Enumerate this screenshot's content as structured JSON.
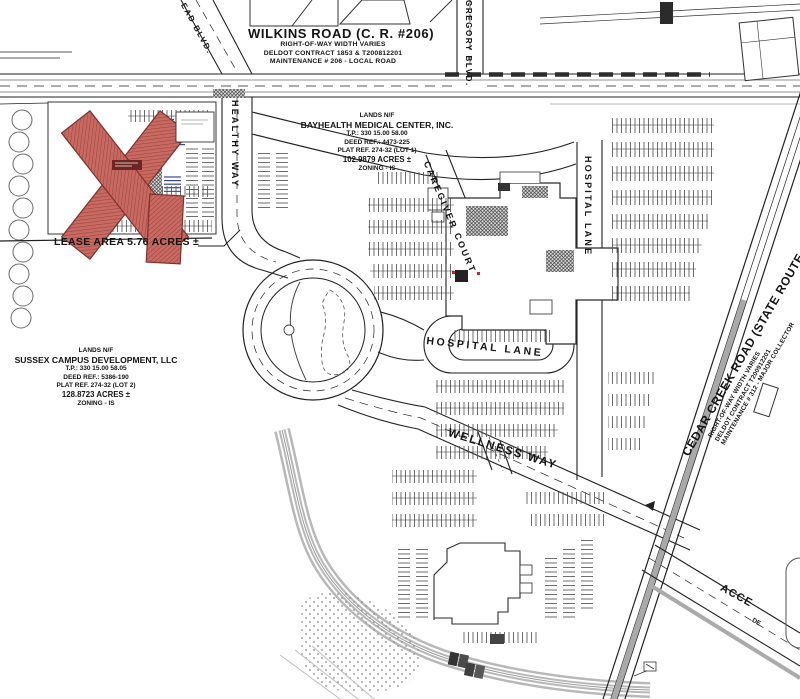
{
  "drawing": {
    "roads": {
      "wilkins": {
        "name": "WILKINS ROAD (C. R. #206)",
        "row": "RIGHT-OF-WAY WIDTH VARIES",
        "contract": "DELDOT CONTRACT 1853 & T200812201",
        "maintenance": "MAINTENANCE # 206 - LOCAL ROAD"
      },
      "ead_blvd": {
        "name": "EAD BLVD."
      },
      "gregory_blvd": {
        "name": "GREGORY BLVD."
      },
      "healthy_way": {
        "name": "HEALTHY WAY"
      },
      "caregiver_court": {
        "name": "CAREGIVER COURT"
      },
      "hospital_lane_upper": {
        "name": "HOSPITAL LANE"
      },
      "hospital_lane_lower": {
        "name": "HOSPITAL LANE"
      },
      "wellness_way": {
        "name": "WELLNESS WAY"
      },
      "cedar_creek": {
        "name": "CEDAR CREEK ROAD (STATE ROUTE 30)",
        "row": "RIGHT-OF-WAY WIDTH VARIES",
        "contract": "DELDOT CONTRACT T200912201",
        "maintenance": "MAINTENANCE # 312 - MAJOR COLLECTOR"
      },
      "access_road": {
        "name": "ACCE",
        "partial_note": "DE"
      }
    },
    "parcels": {
      "bayhealth": {
        "lands": "LANDS N/F",
        "owner": "BAYHEALTH MEDICAL CENTER, INC.",
        "tax_parcel": "T.P.: 330 15.00 58.00",
        "deed_ref": "DEED REF.: 4473-225",
        "plat_ref": "PLAT REF. 274-32 (LOT 1)",
        "acreage": "102.9879 ACRES ±",
        "zoning": "ZONING - IS"
      },
      "sussex": {
        "lands": "LANDS N/F",
        "owner": "SUSSEX CAMPUS DEVELOPMENT, LLC",
        "tax_parcel": "T.P.: 330 15.00 58.05",
        "deed_ref": "DEED REF.: 5386-190",
        "plat_ref": "PLAT REF. 274-32 (LOT 2)",
        "acreage": "128.8723 ACRES ±",
        "zoning": "ZONING - IS"
      },
      "lease": {
        "callout": "LEASE AREA 5.76 ACRES ±"
      }
    },
    "colors": {
      "building_red": "#c96a62",
      "building_red_dark": "#8e3b35",
      "handicap_blue": "#2e3d96",
      "line": "#1c1c1c",
      "road_gray": "#b3b3b3"
    }
  }
}
